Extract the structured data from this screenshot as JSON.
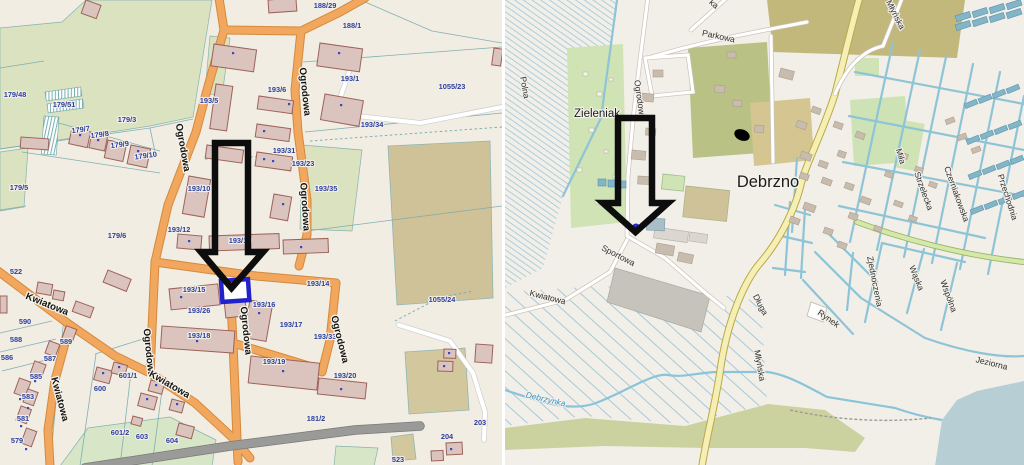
{
  "app": {
    "description": "Side-by-side map views of Debrzno: cadastral parcel map (left) and OpenStreetMap-style town map (right), each with a large black arrow marker pointing to the selected location",
    "place_name": "Debrzno",
    "river_name": "Debrzynka"
  },
  "colors": {
    "left_bg": "#f1ede2",
    "road_orange": "#f2a75f",
    "road_orange_casing": "#d5893c",
    "building_fill": "#dcc4be",
    "building_stroke": "#9c625b",
    "parcel_line": "#74aaad",
    "parcel_text": "#2b3f9e",
    "green": "#dbe2c0",
    "field_tan": "#cfc298",
    "gray_road": "#9a9a98",
    "right_bg": "#f2efe9",
    "water": "#b7ced5",
    "osm_green": "#cfe3b4",
    "olive": "#c2b87c",
    "allotment_tan": "#d4c591",
    "cyan_line": "#8ec4d6",
    "teal_building": "#83b5c9",
    "yellow_road": "#f5efb5",
    "highlight_blue": "#2222cc",
    "arrow_black": "#0d0d0d"
  },
  "left_map": {
    "type": "cadastral-parcel-map",
    "selected_parcel_highlight": "blue outlined building",
    "labels": [
      {
        "t": "179/48",
        "x": 15,
        "y": 97,
        "k": "parcel"
      },
      {
        "t": "179/51",
        "x": 64,
        "y": 107,
        "k": "parcel"
      },
      {
        "t": "179/3",
        "x": 127,
        "y": 122,
        "k": "parcel"
      },
      {
        "t": "179/7",
        "x": 81,
        "y": 132,
        "r": -8,
        "k": "parcel"
      },
      {
        "t": "179/8",
        "x": 100,
        "y": 137,
        "r": -8,
        "k": "parcel"
      },
      {
        "t": "179/9",
        "x": 120,
        "y": 147,
        "r": -8,
        "k": "parcel"
      },
      {
        "t": "179/10",
        "x": 146,
        "y": 158,
        "r": -8,
        "k": "parcel"
      },
      {
        "t": "179/5",
        "x": 19,
        "y": 190,
        "k": "parcel"
      },
      {
        "t": "179/6",
        "x": 117,
        "y": 238,
        "k": "parcel"
      },
      {
        "t": "188/29",
        "x": 325,
        "y": 8,
        "k": "parcel"
      },
      {
        "t": "188/1",
        "x": 352,
        "y": 28,
        "k": "parcel"
      },
      {
        "t": "193/1",
        "x": 350,
        "y": 81,
        "k": "parcel"
      },
      {
        "t": "1055/23",
        "x": 452,
        "y": 89,
        "k": "parcel"
      },
      {
        "t": "193/34",
        "x": 372,
        "y": 127,
        "k": "parcel"
      },
      {
        "t": "193/5",
        "x": 209,
        "y": 103,
        "k": "parcel"
      },
      {
        "t": "193/6",
        "x": 277,
        "y": 92,
        "k": "parcel"
      },
      {
        "t": "193/31",
        "x": 284,
        "y": 153,
        "k": "parcel"
      },
      {
        "t": "193/23",
        "x": 303,
        "y": 166,
        "k": "parcel"
      },
      {
        "t": "193/35",
        "x": 326,
        "y": 191,
        "k": "parcel"
      },
      {
        "t": "193/10",
        "x": 199,
        "y": 191,
        "k": "parcel"
      },
      {
        "t": "193/12",
        "x": 179,
        "y": 232,
        "k": "parcel"
      },
      {
        "t": "193/13",
        "x": 240,
        "y": 243,
        "k": "parcel"
      },
      {
        "t": "193/15",
        "x": 194,
        "y": 292,
        "k": "parcel"
      },
      {
        "t": "193/26",
        "x": 199,
        "y": 313,
        "k": "parcel"
      },
      {
        "t": "193/18",
        "x": 199,
        "y": 338,
        "k": "parcel"
      },
      {
        "t": "193/16",
        "x": 264,
        "y": 307,
        "k": "parcel"
      },
      {
        "t": "193/14",
        "x": 318,
        "y": 286,
        "k": "parcel"
      },
      {
        "t": "193/17",
        "x": 291,
        "y": 327,
        "k": "parcel"
      },
      {
        "t": "193/33",
        "x": 325,
        "y": 339,
        "k": "parcel"
      },
      {
        "t": "193/19",
        "x": 274,
        "y": 364,
        "k": "parcel"
      },
      {
        "t": "193/20",
        "x": 345,
        "y": 378,
        "k": "parcel"
      },
      {
        "t": "1055/24",
        "x": 442,
        "y": 302,
        "k": "parcel"
      },
      {
        "t": "181/2",
        "x": 316,
        "y": 421,
        "k": "parcel"
      },
      {
        "t": "203",
        "x": 480,
        "y": 425,
        "k": "parcel"
      },
      {
        "t": "204",
        "x": 447,
        "y": 439,
        "k": "parcel"
      },
      {
        "t": "523",
        "x": 398,
        "y": 462,
        "k": "parcel"
      },
      {
        "t": "522",
        "x": 16,
        "y": 274,
        "k": "parcel"
      },
      {
        "t": "590",
        "x": 25,
        "y": 324,
        "k": "parcel"
      },
      {
        "t": "588",
        "x": 16,
        "y": 342,
        "k": "parcel"
      },
      {
        "t": "586",
        "x": 7,
        "y": 360,
        "k": "parcel"
      },
      {
        "t": "589",
        "x": 66,
        "y": 344,
        "k": "parcel"
      },
      {
        "t": "587",
        "x": 50,
        "y": 361,
        "k": "parcel"
      },
      {
        "t": "585",
        "x": 36,
        "y": 379,
        "k": "parcel"
      },
      {
        "t": "583",
        "x": 28,
        "y": 399,
        "k": "parcel"
      },
      {
        "t": "581",
        "x": 23,
        "y": 421,
        "k": "parcel"
      },
      {
        "t": "579",
        "x": 17,
        "y": 443,
        "k": "parcel"
      },
      {
        "t": "600",
        "x": 100,
        "y": 391,
        "k": "parcel"
      },
      {
        "t": "601/1",
        "x": 128,
        "y": 378,
        "k": "parcel"
      },
      {
        "t": "601/2",
        "x": 120,
        "y": 435,
        "k": "parcel"
      },
      {
        "t": "603",
        "x": 142,
        "y": 439,
        "k": "parcel"
      },
      {
        "t": "604",
        "x": 172,
        "y": 443,
        "k": "parcel"
      },
      {
        "t": "Ogrodowa",
        "x": 180,
        "y": 148,
        "r": 80,
        "k": "streetL"
      },
      {
        "t": "Ogrodowa",
        "x": 302,
        "y": 92,
        "r": 84,
        "k": "streetL"
      },
      {
        "t": "Ogrodowa",
        "x": 302,
        "y": 207,
        "r": 86,
        "k": "streetL"
      },
      {
        "t": "Ogrodowa",
        "x": 243,
        "y": 331,
        "r": 84,
        "k": "streetL"
      },
      {
        "t": "Ogrodowa",
        "x": 337,
        "y": 340,
        "r": 76,
        "k": "streetL"
      },
      {
        "t": "Ogrodowa",
        "x": 146,
        "y": 353,
        "r": 84,
        "k": "streetL"
      },
      {
        "t": "Kwiatowa",
        "x": 46,
        "y": 307,
        "r": 22,
        "k": "streetL"
      },
      {
        "t": "Kwiatowa",
        "x": 57,
        "y": 400,
        "r": 75,
        "k": "streetL"
      },
      {
        "t": "Kwiatowa",
        "x": 168,
        "y": 387,
        "r": 30,
        "k": "streetL"
      }
    ]
  },
  "right_map": {
    "type": "osm-town-map",
    "selected_point_marker": "blue dot",
    "labels": [
      {
        "t": "Polna",
        "x": 17,
        "y": 88,
        "r": 80,
        "k": "streetR"
      },
      {
        "t": "ka",
        "x": 207,
        "y": 6,
        "r": 42,
        "k": "partial"
      },
      {
        "t": "Parkowa",
        "x": 213,
        "y": 39,
        "r": 12,
        "k": "streetR"
      },
      {
        "t": "Ogrodowa",
        "x": 132,
        "y": 100,
        "r": 82,
        "k": "streetR"
      },
      {
        "t": "Zieleniak",
        "x": 92,
        "y": 117,
        "k": "area"
      },
      {
        "t": "Debrzno",
        "x": 263,
        "y": 187,
        "k": "place"
      },
      {
        "t": "Sportowa",
        "x": 112,
        "y": 258,
        "r": 27,
        "k": "streetR"
      },
      {
        "t": "Kwiatowa",
        "x": 42,
        "y": 300,
        "r": 14,
        "k": "streetR"
      },
      {
        "t": "Długa",
        "x": 253,
        "y": 306,
        "r": 62,
        "k": "streetR"
      },
      {
        "t": "Młyńska",
        "x": 252,
        "y": 366,
        "r": 80,
        "k": "streetR"
      },
      {
        "t": "Debrzynka",
        "x": 40,
        "y": 402,
        "r": 13,
        "k": "water"
      },
      {
        "t": "Młyńska",
        "x": 388,
        "y": 16,
        "r": 63,
        "k": "streetR"
      },
      {
        "t": "Miła",
        "x": 393,
        "y": 157,
        "r": 73,
        "k": "streetR"
      },
      {
        "t": "Strzelecka",
        "x": 416,
        "y": 192,
        "r": 70,
        "k": "streetR"
      },
      {
        "t": "Czerniakowska",
        "x": 449,
        "y": 195,
        "r": 70,
        "k": "streetR"
      },
      {
        "t": "Przechodnia",
        "x": 500,
        "y": 198,
        "r": 72,
        "k": "streetR"
      },
      {
        "t": "Wąska",
        "x": 409,
        "y": 279,
        "r": 68,
        "k": "streetR"
      },
      {
        "t": "Wspólna",
        "x": 441,
        "y": 297,
        "r": 70,
        "k": "streetR"
      },
      {
        "t": "Zjednoczenia",
        "x": 367,
        "y": 282,
        "r": 79,
        "k": "streetR"
      },
      {
        "t": "Rynek",
        "x": 322,
        "y": 321,
        "r": 35,
        "k": "streetR"
      },
      {
        "t": "Jeziorna",
        "x": 486,
        "y": 366,
        "r": 14,
        "k": "streetR"
      }
    ]
  }
}
